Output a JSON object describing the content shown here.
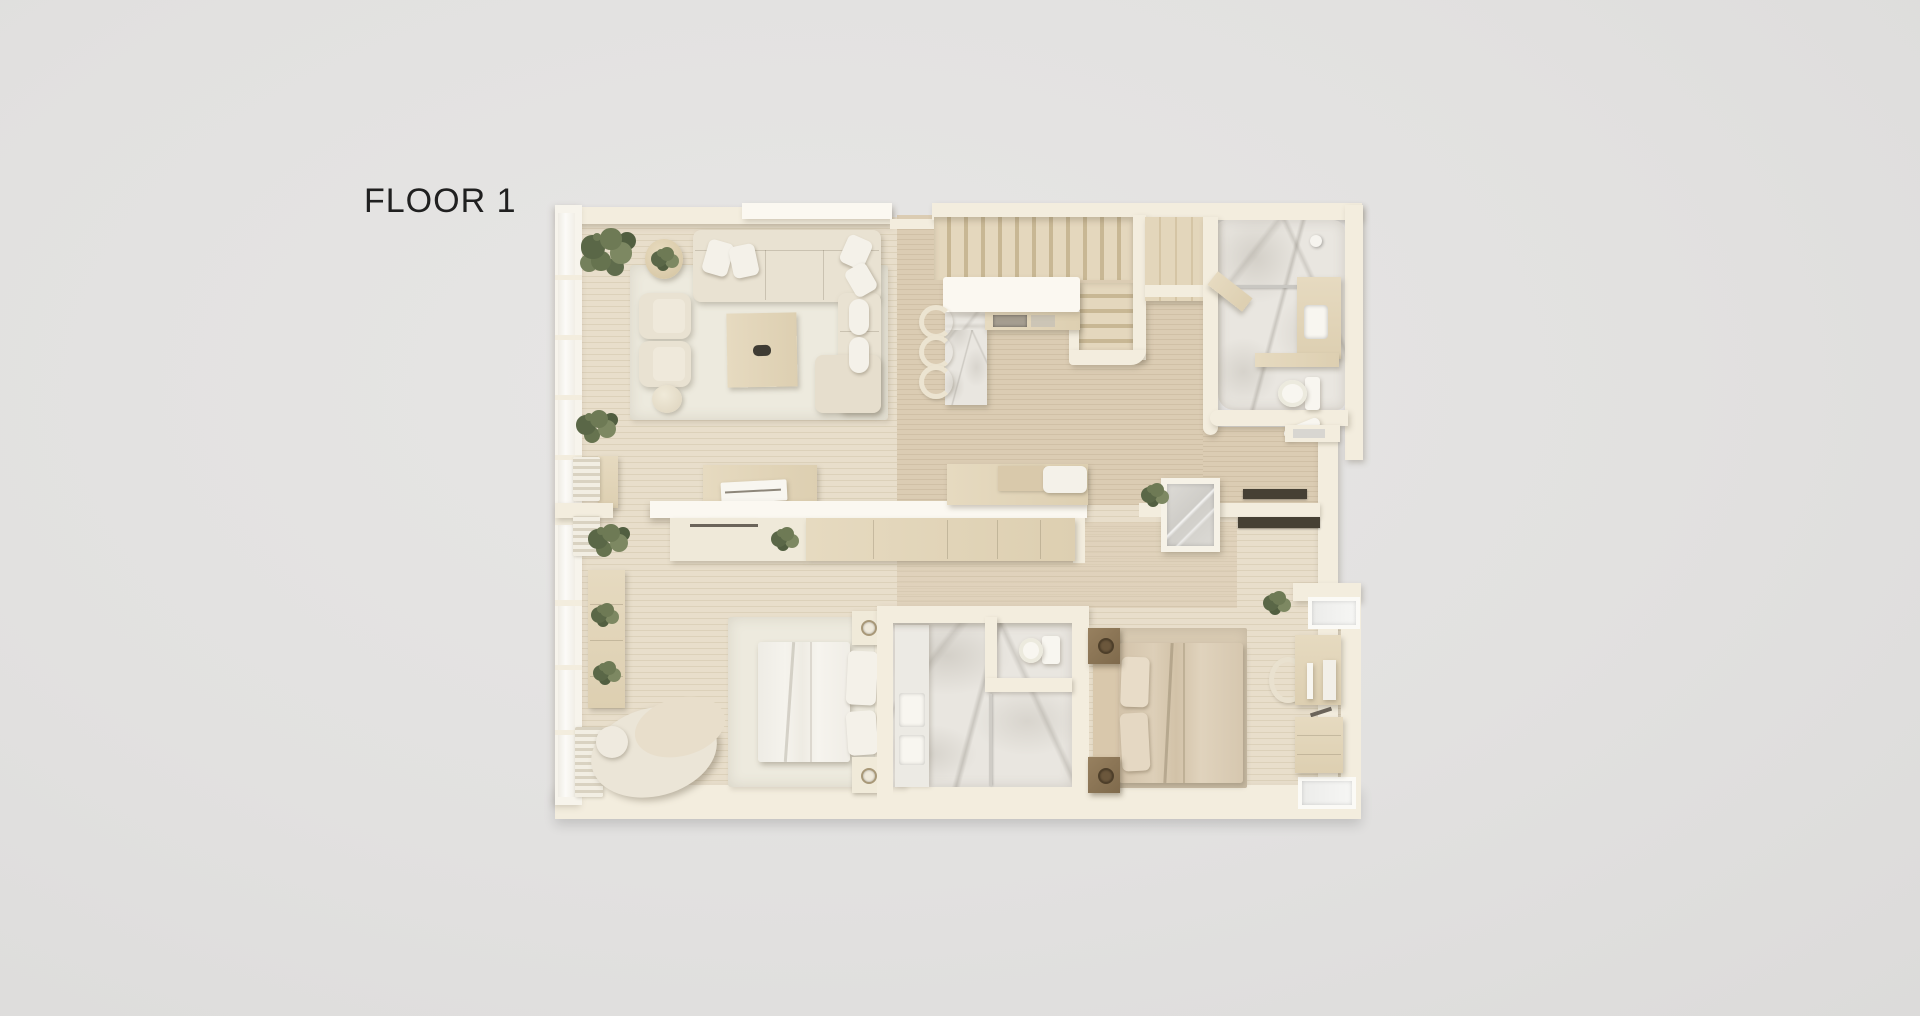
{
  "title": "FLOOR 1",
  "colors": {
    "background": "#e2e1e0",
    "text": "#202020",
    "wall": "#f3edde",
    "wall_bright": "#fbf8f1",
    "wood_light": "#e8decb",
    "wood_tan": "#dbccb3",
    "marble": "#e9e6e0",
    "rug": "#edeade",
    "sofa": "#e9e2d2",
    "wood_furn": "#e6dac0",
    "dark_wood": "#97805f",
    "green": "#6e7a55"
  },
  "scene": {
    "type": "3d-floor-plan-render",
    "rooms": [
      {
        "name": "living-room",
        "furniture": [
          "l-shaped-sofa",
          "coffee-table",
          "armchairs",
          "side-table",
          "stool",
          "plants",
          "rug"
        ]
      },
      {
        "name": "stair-kitchen-hall",
        "furniture": [
          "staircase",
          "kitchen-counter",
          "bar-stools",
          "pantry-cabinet"
        ]
      },
      {
        "name": "bathroom-top",
        "furniture": [
          "shower",
          "toilet",
          "vanity-cabinet",
          "wood-shelf",
          "bath-mat"
        ]
      },
      {
        "name": "hallway",
        "furniture": [
          "console-wall",
          "desk",
          "laptop",
          "chair",
          "sideboard",
          "daybed",
          "glass-vestibule",
          "wardrobe-rods"
        ]
      },
      {
        "name": "bedroom-left",
        "furniture": [
          "double-bed",
          "nightstands",
          "chaise-lounge",
          "wall-shelf",
          "radiators",
          "rug"
        ]
      },
      {
        "name": "bathroom-bottom",
        "furniture": [
          "double-vanity",
          "toilet",
          "shower"
        ]
      },
      {
        "name": "bedroom-right",
        "furniture": [
          "double-bed",
          "nightstands",
          "desk",
          "monitor",
          "chair",
          "dresser",
          "rug"
        ]
      }
    ]
  }
}
